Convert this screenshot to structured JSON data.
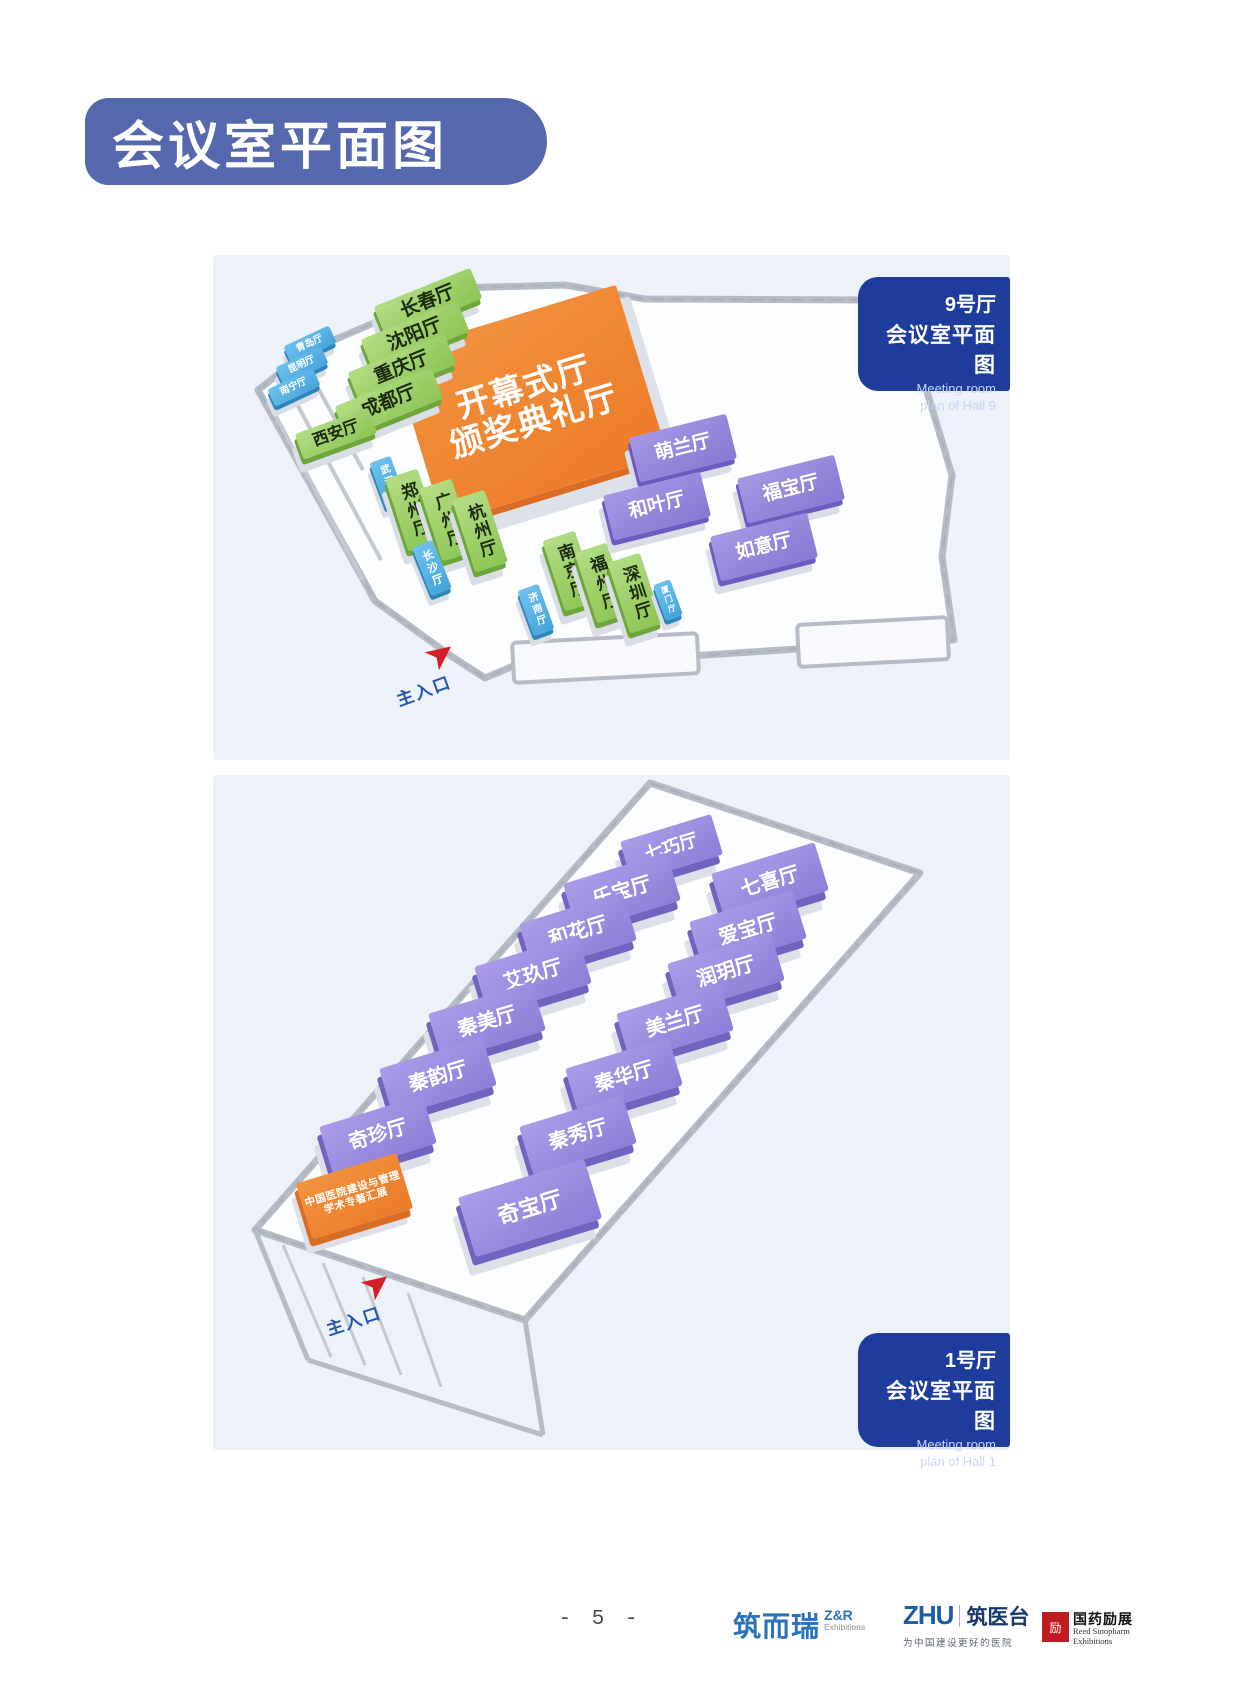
{
  "page": {
    "title": "会议室平面图",
    "page_number": "- 5 -"
  },
  "icons": {
    "entrance_arrow": "➤"
  },
  "colors": {
    "banner_blue": "#5568ae",
    "badge_blue": "#1e3c9b",
    "panel_bg": "#edf1f8",
    "room_green": "#8bc553",
    "room_blue": "#45a4d8",
    "room_purple": "#8d7dd8",
    "room_orange": "#ec7a28",
    "arrow_red": "#d41f26",
    "entrance_text_blue": "#2456b0"
  },
  "hall9": {
    "badge": {
      "hall": "9号厅",
      "title": "会议室平面图",
      "subtitle1": "Meeting room",
      "subtitle2": "plan of Hall 9"
    },
    "main_hall": {
      "line1": "开幕式厅",
      "line2": "颁奖典礼厅"
    },
    "entrance_label": "主入口",
    "rooms": [
      "长春厅",
      "沈阳厅",
      "重庆厅",
      "成都厅",
      "西安厅",
      "青岛厅",
      "昆明厅",
      "南宁厅",
      "武汉厅",
      "郑州厅",
      "广州厅",
      "杭州厅",
      "长沙厅",
      "南京厅",
      "福州厅",
      "深圳厅",
      "济南厅",
      "厦门厅",
      "萌兰厅",
      "福宝厅",
      "和叶厅",
      "如意厅"
    ]
  },
  "hall1": {
    "badge": {
      "hall": "1号厅",
      "title": "会议室平面图",
      "subtitle1": "Meeting room",
      "subtitle2": "plan of Hall 1"
    },
    "special_booth": {
      "line1": "中国医院建设与管理",
      "line2": "学术专著汇展"
    },
    "entrance_label": "主入口",
    "rooms": [
      "七巧厅",
      "七喜厅",
      "乐宝厅",
      "爱宝厅",
      "和花厅",
      "润玥厅",
      "艾玖厅",
      "美兰厅",
      "秦美厅",
      "秦华厅",
      "秦韵厅",
      "秦秀厅",
      "奇珍厅",
      "奇宝厅"
    ]
  },
  "footer": {
    "logo_zr": {
      "cn": "筑而瑞",
      "en1": "Z&R",
      "en2": "Exhibitions"
    },
    "logo_zhu": {
      "en": "ZHU",
      "cn": "筑医台",
      "tagline": "为中国建设更好的医院"
    },
    "logo_sinopharm": {
      "seal": "励",
      "cn": "国药励展",
      "en1": "Reed Sinopharm",
      "en2": "Exhibitions"
    }
  }
}
